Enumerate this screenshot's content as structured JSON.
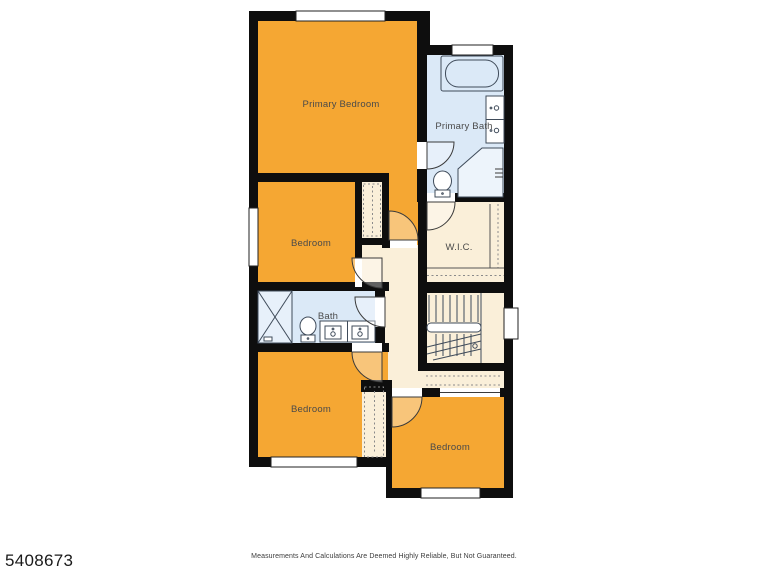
{
  "colors": {
    "background": "#FFFFFF",
    "room_orange": "#F5A733",
    "room_blue": "#DBE9F7",
    "room_cream": "#FAEFD9",
    "wall": "#0E0E0E",
    "fixture_line": "#3F4B5A",
    "label_text": "#4A4A4A"
  },
  "rooms": {
    "primary_bedroom": {
      "label": "Primary Bedroom"
    },
    "primary_bath": {
      "label": "Primary Bath"
    },
    "bedroom_upper": {
      "label": "Bedroom"
    },
    "wic": {
      "label": "W.I.C."
    },
    "bath": {
      "label": "Bath"
    },
    "bedroom_lower_left": {
      "label": "Bedroom"
    },
    "bedroom_lower_right": {
      "label": "Bedroom"
    }
  },
  "footer": {
    "listing_id": "5408673",
    "disclaimer": "Measurements And Calculations Are Deemed Highly Reliable, But Not Guaranteed."
  }
}
